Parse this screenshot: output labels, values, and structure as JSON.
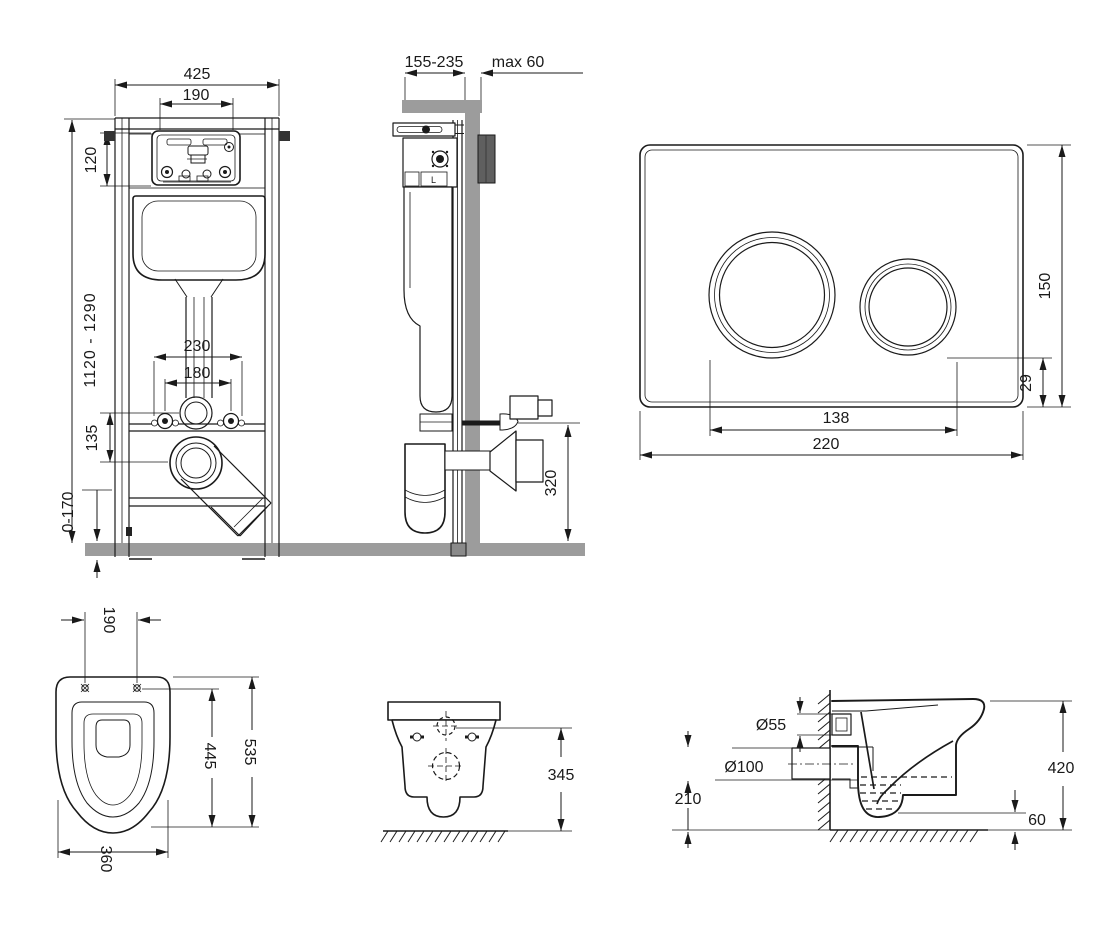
{
  "palette": {
    "ink": "#1a1a1a",
    "concrete": "#9c9c9c",
    "background": "#ffffff"
  },
  "frame_front": {
    "dims": {
      "width": "425",
      "access_width": "190",
      "access_height": "120",
      "height_range": "1120 - 1290",
      "anchor_span": "230",
      "bolt_span": "180",
      "pipe_drop": "135",
      "foot_range": "0-170"
    }
  },
  "frame_side": {
    "dims": {
      "depth_range": "155-235",
      "wall_max": "max 60",
      "outlet_height": "320"
    },
    "mech_label": "L"
  },
  "flush_plate": {
    "dims": {
      "height": "150",
      "bottom_offset": "29",
      "span": "138",
      "width": "220"
    }
  },
  "bowl_top": {
    "dims": {
      "hole_span": "190",
      "hole_depth": "445",
      "length": "535",
      "width": "360"
    }
  },
  "bowl_front": {
    "dims": {
      "height": "345"
    }
  },
  "bowl_side": {
    "dims": {
      "inlet": "Ø55",
      "outlet": "Ø100",
      "outlet_height": "210",
      "height": "420",
      "clearance": "60"
    }
  }
}
